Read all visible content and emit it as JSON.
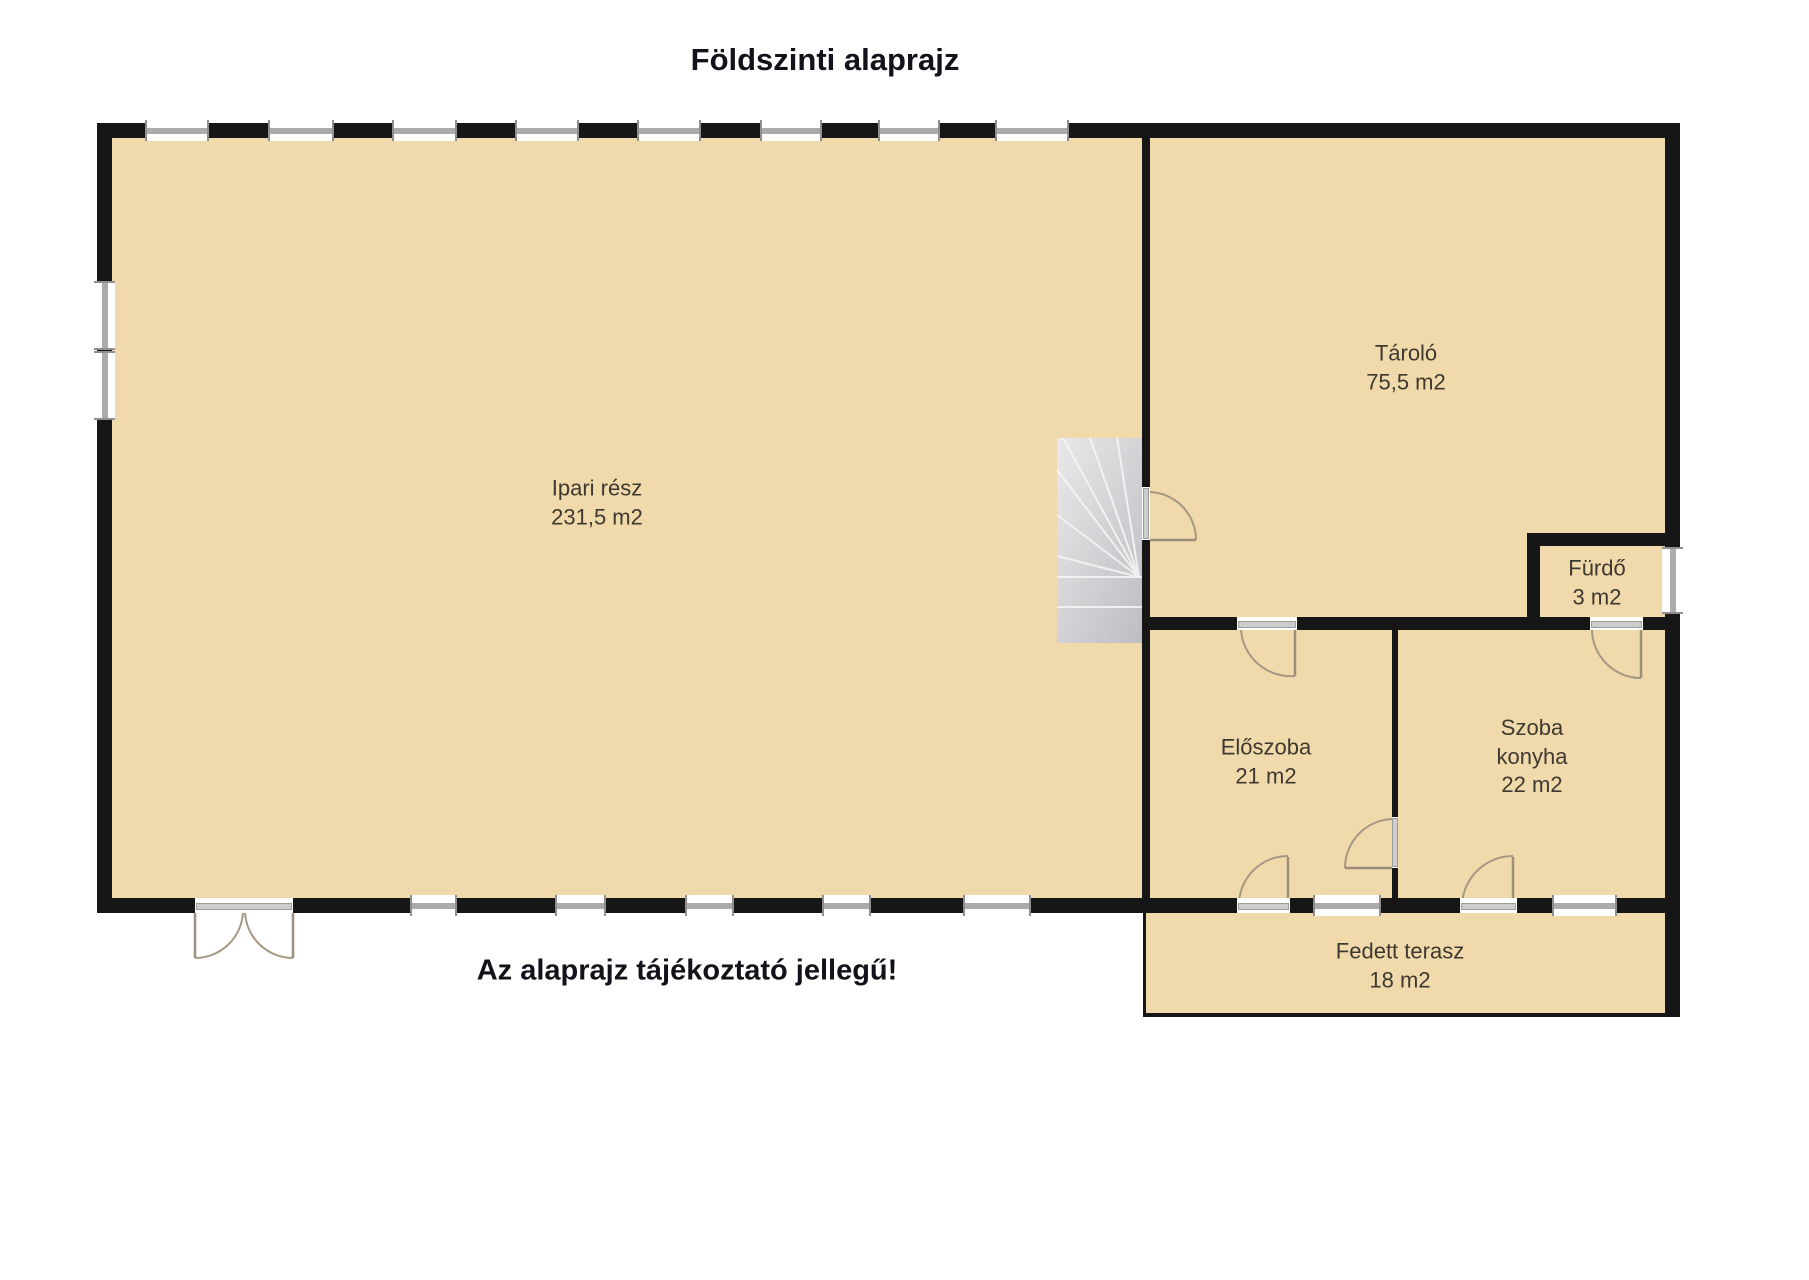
{
  "title": "Földszinti alaprajz",
  "disclaimer": "Az alaprajz tájékoztató jellegű!",
  "colors": {
    "room_fill": "#f0d9ab",
    "wall": "#161616",
    "stairs_light": "#e8e8ea",
    "stairs_dark": "#bfbfc3",
    "door_arc": "#a69885",
    "window_frame": "#8f8f8f",
    "label_text": "#3e3930",
    "heading_text": "#12121a"
  },
  "rooms": [
    {
      "id": "ipari-resz",
      "name": "Ipari rész",
      "area": "231,5 m2"
    },
    {
      "id": "tarolo",
      "name": "Tároló",
      "area": "75,5 m2"
    },
    {
      "id": "furdo",
      "name": "Fürdő",
      "area": "3 m2"
    },
    {
      "id": "eloszoba",
      "name": "Előszoba",
      "area": "21 m2"
    },
    {
      "id": "szoba-konyha",
      "name": "Szoba\nkonyha",
      "area": "22 m2"
    },
    {
      "id": "fedett-terasz",
      "name": "Fedett terasz",
      "area": "18 m2"
    }
  ]
}
